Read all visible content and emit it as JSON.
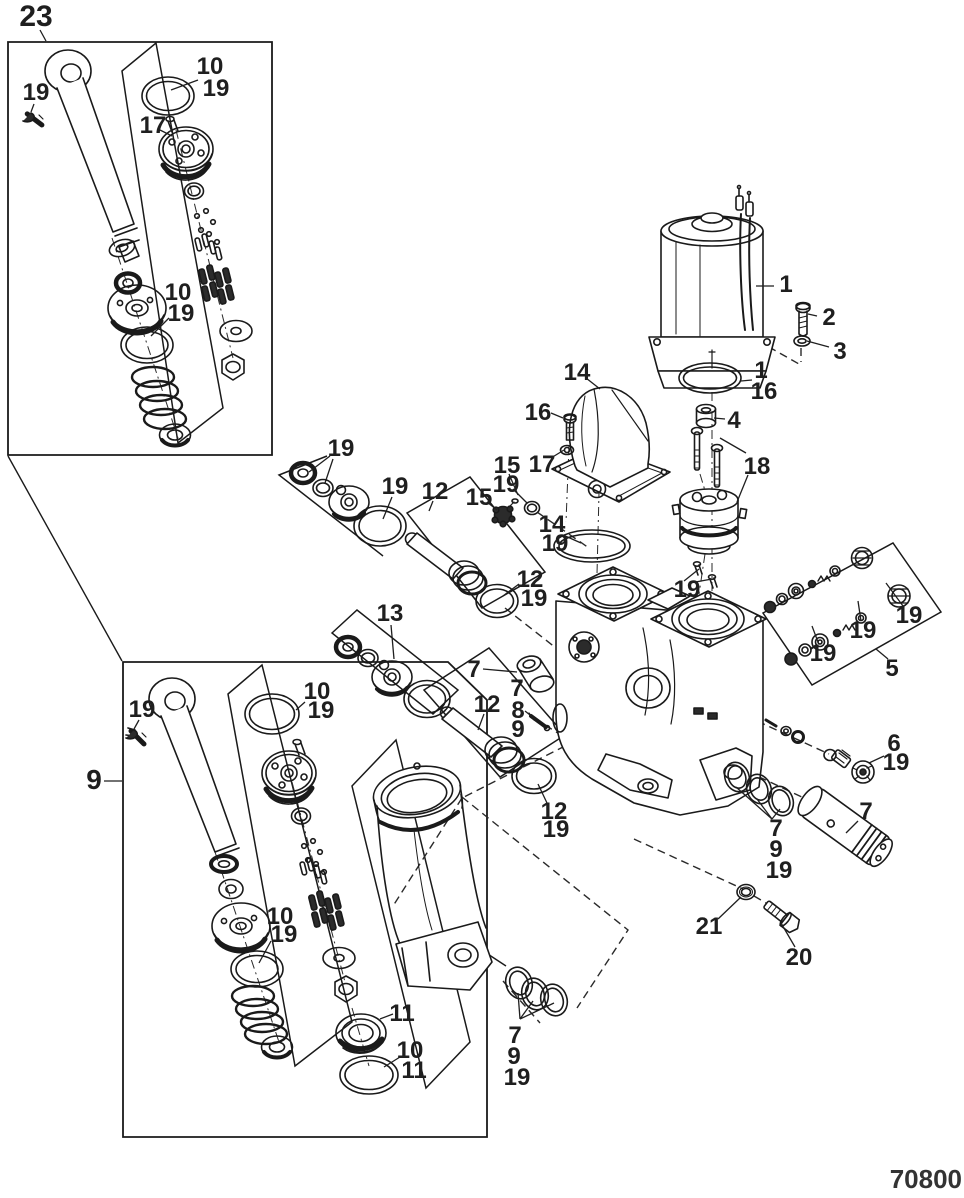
{
  "figure": {
    "part_number": "70800",
    "type": "exploded-parts-diagram",
    "subject": "power trim / tilt hydraulic assembly"
  },
  "colors": {
    "line": "#1a1a1a",
    "label": "#1f1f1f",
    "background": "#ffffff",
    "dark_fill": "#2b2b2b"
  },
  "diagram": {
    "boxes": [
      {
        "name": "detail-box-23",
        "pts": "8,42 272,42 272,455 8,455",
        "closed": true
      },
      {
        "name": "detail-box-9",
        "pts": "123,662 448,662 487,700 487,1137 123,1137",
        "closed": true
      }
    ],
    "brackets": [
      {
        "name": "valve-subassembly-bracket-23",
        "pts": "122,71 156,43 223,408 178,443",
        "closed": true
      },
      {
        "name": "valve-subassembly-bracket-9",
        "pts": "228,694 262,665 352,1022 295,1066",
        "closed": true
      },
      {
        "name": "cylinder-bracket-9",
        "pts": "352,786 396,740 470,1042 426,1088",
        "closed": true
      },
      {
        "name": "seal-kit-bracket-upper",
        "pts": "327,456 279,475 383,556",
        "closed": false
      },
      {
        "name": "rod-bracket-upper",
        "pts": "407,513 470,477 545,572 482,608",
        "closed": true
      },
      {
        "name": "seal-kit-bracket-13",
        "pts": "332,633 357,610 458,690 433,714",
        "closed": true
      },
      {
        "name": "rod-bracket-lower",
        "pts": "424,690 489,648 565,735 500,777",
        "closed": true
      },
      {
        "name": "check-valve-kit-bracket-5",
        "pts": "763,613 893,543 941,612 812,685",
        "closed": true
      }
    ],
    "links": [
      [
        8,
        456,
        122,
        661
      ],
      [
        468,
        941,
        506,
        966
      ]
    ],
    "axes": [
      "112,238 178,438",
      "176,130 233,358",
      "215,852 279,1042",
      "292,782 345,982",
      "352,1008 369,1066",
      "712,240 712,594",
      "601,412 597,574",
      "569,446 566,522",
      "700,474 706,494",
      "717,491 712,506",
      "705,554 699,594"
    ],
    "dashes": [
      "746,334 799,364",
      "801,348 801,362",
      "537,512 589,548",
      "505,608 556,648",
      "545,725 561,735",
      "722,705 829,754",
      "700,749 806,799",
      "634,839 743,889",
      "754,896 766,903",
      "565,746 462,798",
      "462,798 393,906",
      "462,797 628,930 577,1008",
      "503,981 540,1023"
    ],
    "leaders": [
      [
        40,
        30,
        46,
        41
      ],
      [
        34,
        104,
        31,
        112
      ],
      [
        198,
        80,
        171,
        90
      ],
      [
        160,
        130,
        172,
        136
      ],
      [
        169,
        318,
        151,
        336
      ],
      [
        756,
        286,
        774,
        286
      ],
      [
        817,
        316,
        808,
        314
      ],
      [
        829,
        347,
        807,
        341
      ],
      [
        752,
        380,
        741,
        381
      ],
      [
        725,
        419,
        714,
        418
      ],
      [
        586,
        378,
        600,
        389
      ],
      [
        551,
        413,
        563,
        418
      ],
      [
        551,
        458,
        564,
        450
      ],
      [
        509,
        474,
        518,
        495
      ],
      [
        513,
        489,
        527,
        503
      ],
      [
        487,
        502,
        497,
        510
      ],
      [
        563,
        535,
        581,
        543
      ],
      [
        746,
        453,
        720,
        438
      ],
      [
        748,
        475,
        737,
        502
      ],
      [
        684,
        581,
        699,
        569
      ],
      [
        690,
        583,
        712,
        579
      ],
      [
        330,
        456,
        309,
        472
      ],
      [
        333,
        459,
        325,
        483
      ],
      [
        392,
        497,
        383,
        519
      ],
      [
        433,
        501,
        429,
        511
      ],
      [
        519,
        584,
        503,
        596
      ],
      [
        391,
        625,
        394,
        659
      ],
      [
        483,
        669,
        517,
        672
      ],
      [
        525,
        711,
        535,
        719
      ],
      [
        484,
        714,
        478,
        730
      ],
      [
        547,
        803,
        538,
        784
      ],
      [
        818,
        642,
        812,
        626
      ],
      [
        861,
        621,
        858,
        601
      ],
      [
        903,
        606,
        886,
        583
      ],
      [
        888,
        659,
        876,
        649
      ],
      [
        884,
        756,
        869,
        763
      ],
      [
        772,
        819,
        736,
        787
      ],
      [
        772,
        819,
        757,
        799
      ],
      [
        772,
        819,
        780,
        809
      ],
      [
        858,
        821,
        846,
        833
      ],
      [
        718,
        919,
        741,
        897
      ],
      [
        795,
        947,
        781,
        923
      ],
      [
        520,
        1019,
        518,
        993
      ],
      [
        520,
        1019,
        533,
        1001
      ],
      [
        520,
        1019,
        554,
        1003
      ],
      [
        104,
        781,
        122,
        781
      ],
      [
        139,
        720,
        134,
        729
      ],
      [
        305,
        702,
        296,
        710
      ],
      [
        271,
        941,
        259,
        963
      ],
      [
        393,
        1014,
        380,
        1019
      ],
      [
        400,
        1057,
        384,
        1067
      ]
    ],
    "labels": [
      {
        "t": "23",
        "x": 36,
        "y": 26,
        "s": 30
      },
      {
        "t": "19",
        "x": 36,
        "y": 100
      },
      {
        "t": "10",
        "x": 210,
        "y": 74
      },
      {
        "t": "19",
        "x": 216,
        "y": 96
      },
      {
        "t": "17",
        "x": 153,
        "y": 133
      },
      {
        "t": "10",
        "x": 178,
        "y": 300
      },
      {
        "t": "19",
        "x": 181,
        "y": 321
      },
      {
        "t": "1",
        "x": 786,
        "y": 292
      },
      {
        "t": "2",
        "x": 829,
        "y": 325
      },
      {
        "t": "3",
        "x": 840,
        "y": 359
      },
      {
        "t": "1",
        "x": 761,
        "y": 378
      },
      {
        "t": "16",
        "x": 764,
        "y": 399
      },
      {
        "t": "4",
        "x": 734,
        "y": 428
      },
      {
        "t": "14",
        "x": 577,
        "y": 380
      },
      {
        "t": "16",
        "x": 538,
        "y": 420
      },
      {
        "t": "17",
        "x": 542,
        "y": 472
      },
      {
        "t": "15",
        "x": 507,
        "y": 473
      },
      {
        "t": "19",
        "x": 506,
        "y": 492
      },
      {
        "t": "15",
        "x": 479,
        "y": 505
      },
      {
        "t": "14",
        "x": 552,
        "y": 532
      },
      {
        "t": "19",
        "x": 555,
        "y": 551
      },
      {
        "t": "18",
        "x": 757,
        "y": 474
      },
      {
        "t": "19",
        "x": 687,
        "y": 597
      },
      {
        "t": "19",
        "x": 341,
        "y": 456
      },
      {
        "t": "19",
        "x": 395,
        "y": 494
      },
      {
        "t": "12",
        "x": 435,
        "y": 499
      },
      {
        "t": "12",
        "x": 530,
        "y": 587
      },
      {
        "t": "19",
        "x": 534,
        "y": 606
      },
      {
        "t": "13",
        "x": 390,
        "y": 621
      },
      {
        "t": "7",
        "x": 474,
        "y": 677
      },
      {
        "t": "7",
        "x": 517,
        "y": 696
      },
      {
        "t": "8",
        "x": 518,
        "y": 718
      },
      {
        "t": "9",
        "x": 518,
        "y": 737
      },
      {
        "t": "12",
        "x": 487,
        "y": 712
      },
      {
        "t": "12",
        "x": 554,
        "y": 819
      },
      {
        "t": "19",
        "x": 556,
        "y": 837
      },
      {
        "t": "19",
        "x": 823,
        "y": 661
      },
      {
        "t": "19",
        "x": 863,
        "y": 638
      },
      {
        "t": "19",
        "x": 909,
        "y": 623
      },
      {
        "t": "5",
        "x": 892,
        "y": 676
      },
      {
        "t": "6",
        "x": 894,
        "y": 751
      },
      {
        "t": "19",
        "x": 896,
        "y": 770
      },
      {
        "t": "7",
        "x": 776,
        "y": 836
      },
      {
        "t": "9",
        "x": 776,
        "y": 857
      },
      {
        "t": "19",
        "x": 779,
        "y": 878
      },
      {
        "t": "7",
        "x": 866,
        "y": 819
      },
      {
        "t": "21",
        "x": 709,
        "y": 934
      },
      {
        "t": "20",
        "x": 799,
        "y": 965
      },
      {
        "t": "7",
        "x": 515,
        "y": 1043
      },
      {
        "t": "9",
        "x": 514,
        "y": 1064
      },
      {
        "t": "19",
        "x": 517,
        "y": 1085
      },
      {
        "t": "9",
        "x": 94,
        "y": 789,
        "s": 28
      },
      {
        "t": "19",
        "x": 142,
        "y": 717
      },
      {
        "t": "10",
        "x": 317,
        "y": 699
      },
      {
        "t": "19",
        "x": 321,
        "y": 718
      },
      {
        "t": "10",
        "x": 280,
        "y": 924
      },
      {
        "t": "19",
        "x": 284,
        "y": 942
      },
      {
        "t": "11",
        "x": 402,
        "y": 1021
      },
      {
        "t": "10",
        "x": 410,
        "y": 1058
      },
      {
        "t": "11",
        "x": 414,
        "y": 1078
      }
    ]
  }
}
